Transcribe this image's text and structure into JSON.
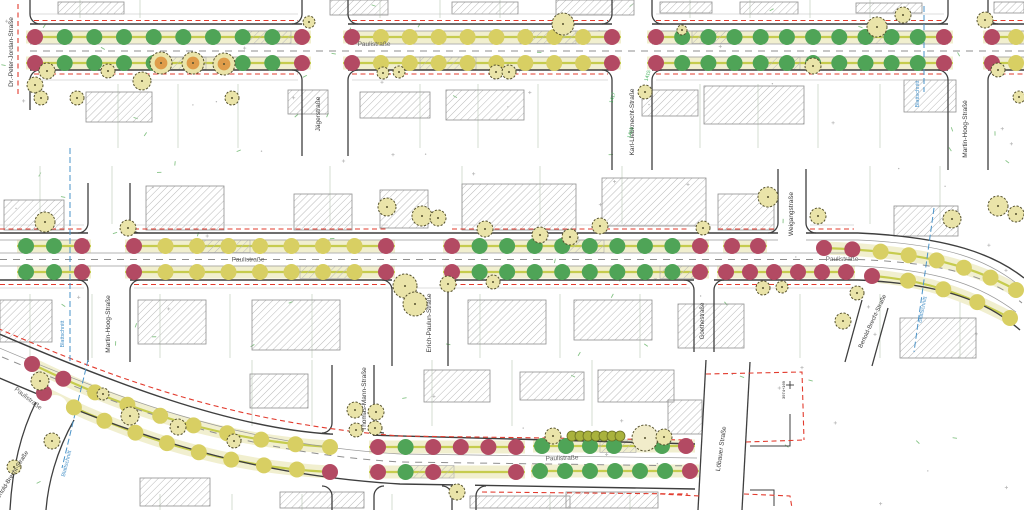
{
  "drawing": {
    "main_street": "Paulistraße",
    "sheet_cut_note": "Blattschnitt"
  },
  "colors": {
    "spot_green": "#4fa457",
    "spot_yellow": "#d8cf63",
    "spot_red": "#b34a63",
    "tree_green": "#eae4a9",
    "tree_pale": "#f1ecca",
    "tree_orange": "#df9c4a",
    "tree_edge": "#55512e",
    "hedge": "#a9b23d",
    "curb": "#3f3f3f",
    "minor_line": "#9a9a9a",
    "sidewalk_line": "#bdbdbd",
    "center_dash": "#8f8f8f",
    "strip_fill": "#f1efcf",
    "strip_line": "#c6cc4e",
    "red_dash": "#e23b2e",
    "blue_line": "#4a93c8",
    "label_dark": "#3a3a3a",
    "label_gray": "#5f5f5f",
    "ref_green": "#3fae57",
    "parcel_line": "#c9d6c6",
    "scatter_green": "#86c386",
    "scatter_gray": "#b5b5b5",
    "building_edge": "#8f8f8f",
    "hatch_line": "#b9b9b9"
  },
  "street_labels": {
    "pauli_p1": "Paulistraße",
    "pauli_p2a": "Paulistraße",
    "pauli_p2b": "Paulistraße",
    "pauli_p3a": "Paulistraße",
    "pauli_p3b": "Paulistraße",
    "dr_peter_jordan": "Dr.-Peter-Jordan-Straße",
    "jaegerstrasse": "Jägerstraße",
    "karl_liebknecht": "Karl-Liebknecht-Straße",
    "martin_hoog_p1": "Martin-Hoog-Straße",
    "martin_hoog_p2": "Martin-Hoog-Straße",
    "erich_paulun": "Erich-Paulun-Straße",
    "goethestrasse": "Goethestraße",
    "weigangstrasse": "Weigangstraße",
    "bertold_brecht_p2": "Bertold-Brecht-Straße",
    "bertold_brecht_p3": "Bertold-Brecht-Straße",
    "thomas_mann": "Thomas-Mann-Straße",
    "loebauer": "Löbauer Straße",
    "blattschnitt_p1": "Blattschnitt",
    "blattschnitt_p2a": "Blattschnitt",
    "blattschnitt_p2b": "Blattschnitt",
    "blattschnitt_p3": "Blattschnitt"
  },
  "ref_labels": {
    "r1415": "1415",
    "r1417": "1417",
    "r1419": "1419",
    "station": "3974+169"
  },
  "dot_rows": {
    "p1_top_a": "RGGGGGGGGR",
    "p1_top_b": "RYYYYYYYYR",
    "p1_top_c": "RGGGGGGGGGGR",
    "p1_top_d": "RY",
    "p1_bot_a": "RGGGG__GGR",
    "p1_bot_b": "RYYYYYYYYR",
    "p1_bot_c": "RGGGGGGGGGGR",
    "p1_bot_d": "RY",
    "p2_top_a": "GGR",
    "p2_top_b": "RYYYYYYYR",
    "p2_top_c": "RGGGGGGGGR",
    "p2_top_d": "RR",
    "p2_top_e": "RRYYYYYY",
    "p2_bot_a": "GGR",
    "p2_bot_b": "RYYYYYYYR",
    "p2_bot_c": "RGGGGGGGGR",
    "p2_bot_d": "RRRRRR",
    "p2_bot_e": "RYYYY",
    "p3_t1": "RRYYYYYYYY",
    "p3_t2": "RGRRRR",
    "p3_t3": "GGGG_GR",
    "p3_b1": "RYYYYYYYYR",
    "p3_b2": "RGR__R",
    "p3_b3": "GGGGGGR"
  }
}
